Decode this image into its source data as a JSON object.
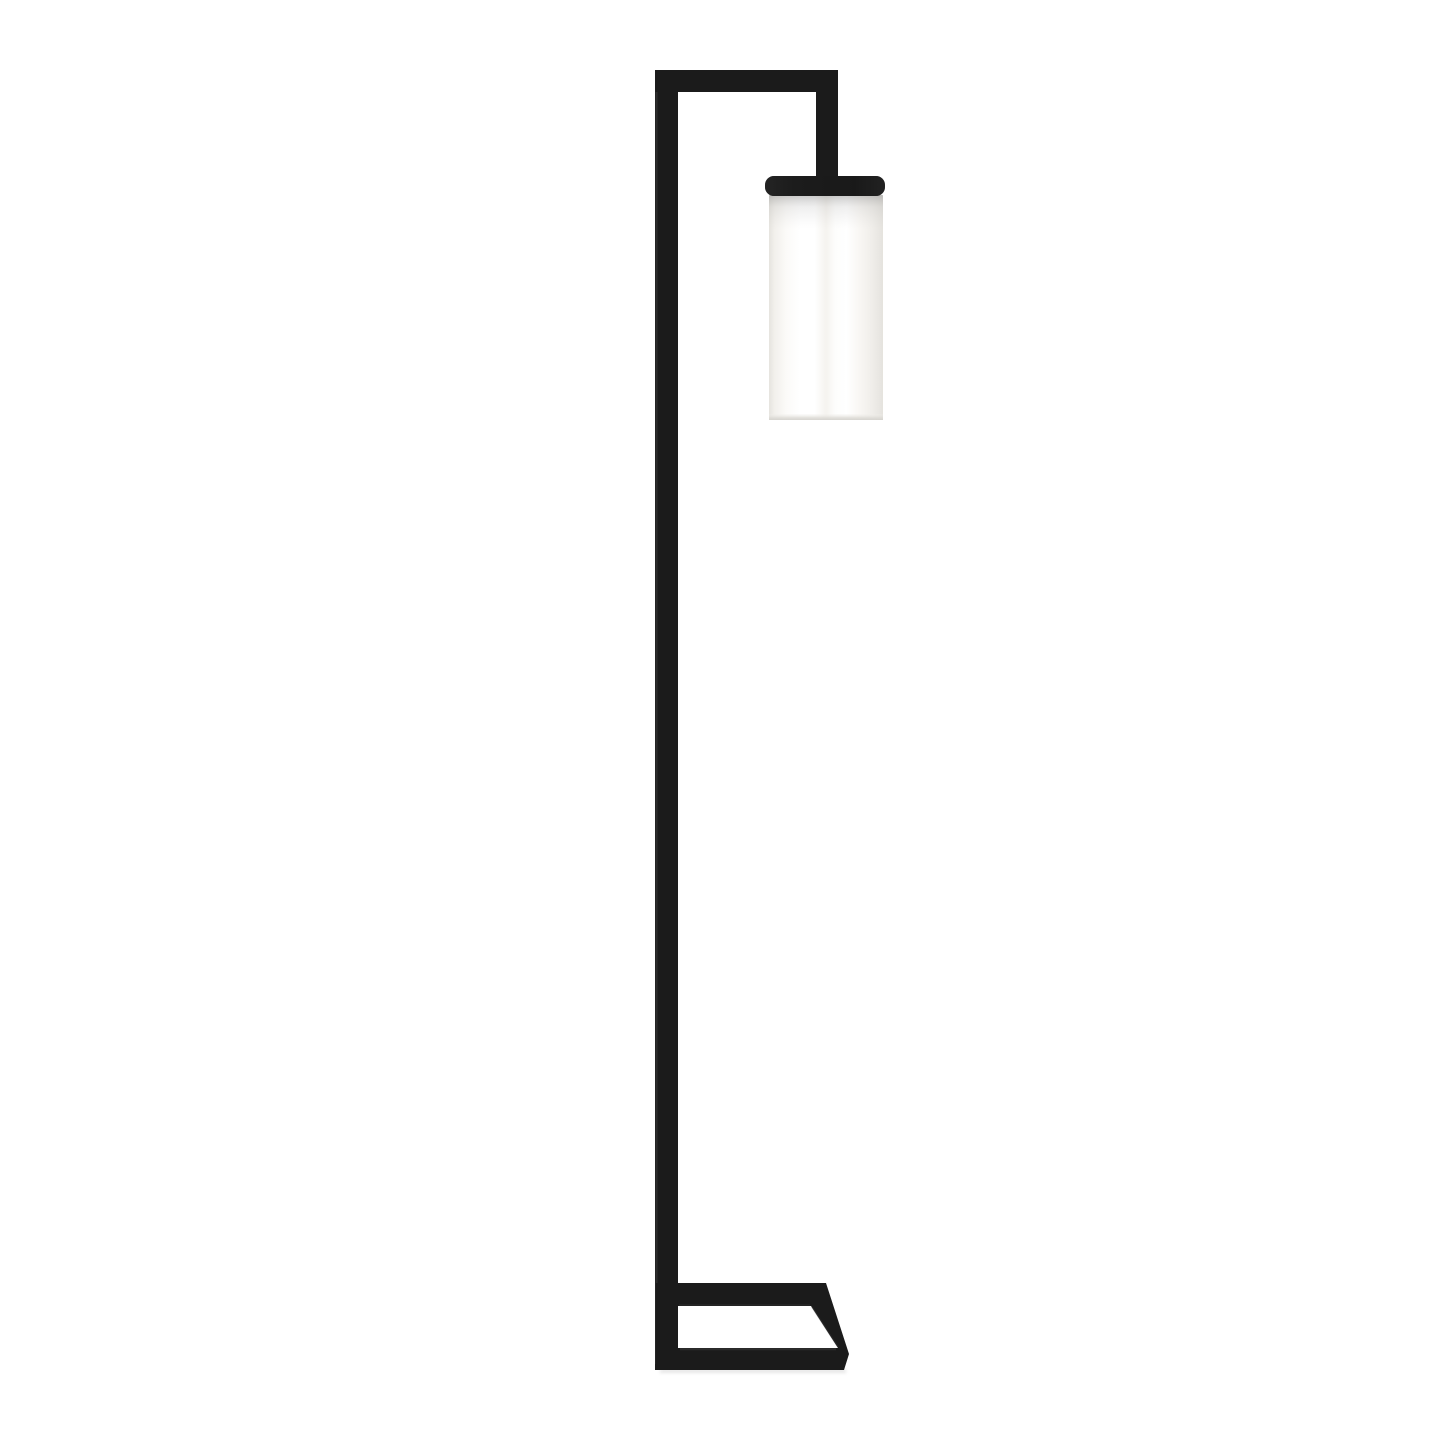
{
  "scene": {
    "type": "product-photograph",
    "description": "Modern minimalist black metal floor lamp with a right-angled overhanging arm, a white frosted-glass cylinder shade with a black metal cap hanging from the arm, and an open rectangular metal base frame, photographed on a plain white background",
    "background_color": "#ffffff"
  },
  "lamp": {
    "metal_color": "#1b1b1b",
    "metal_highlight_color": "#474747",
    "metal_edge_highlight_color": "#3a3a3a",
    "shade_color": "#ffffff",
    "shade_edge_color": "#e6e4df",
    "shade_rim_color": "#dcdad5",
    "floor_shadow_color": "#c9c9c9",
    "parts": {
      "pole": "vertical square metal pole",
      "arm": "horizontal top arm",
      "down_rod": "short vertical rod suspending the shade",
      "shade_cap": "black metal cap on top of the glass shade",
      "shade": "white cylindrical frosted glass shade",
      "base": "open rectangular metal base frame seen in perspective"
    }
  }
}
